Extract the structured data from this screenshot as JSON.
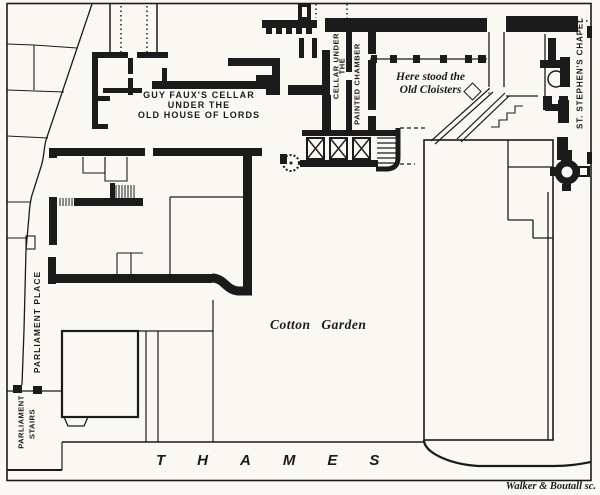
{
  "figure": {
    "title": "Plan of the old Palace of Westminster cellars",
    "colors": {
      "ink": "#1b1b1b",
      "paper": "#f9f8f3"
    }
  },
  "labels": {
    "guy_faux_cellar": {
      "lines": [
        "GUY FAUX'S CELLAR",
        "UNDER THE",
        "OLD HOUSE OF LORDS"
      ]
    },
    "cellar_painted_chamber": {
      "lines": [
        "CELLAR UNDER",
        "THE",
        "PAINTED CHAMBER"
      ]
    },
    "old_cloisters": {
      "lines": [
        "Here stood the",
        "Old Cloisters"
      ]
    },
    "cotton_garden": "Cotton Garden",
    "thames": "THAMES",
    "parliament_place": "PARLIAMENT PLACE",
    "parliament_stairs": {
      "lines": [
        "PARLIAMENT",
        "STAIRS"
      ]
    },
    "st_stephens_chapel": "ST. STEPHEN'S CHAPEL",
    "engraver_credit": "Walker & Boutall sc."
  },
  "symbols": {
    "cloister_marker": "diamond"
  }
}
